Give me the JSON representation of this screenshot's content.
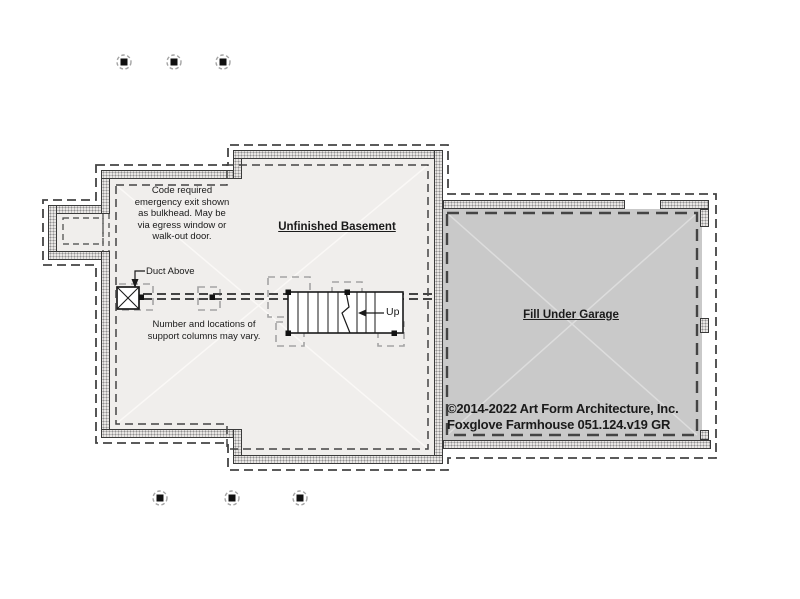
{
  "plan": {
    "labels": {
      "room": "Unfinished Basement",
      "garage": "Fill Under Garage",
      "duct": "Duct Above",
      "stair_direction": "Up"
    },
    "notes": {
      "egress": "Code required\nemergency exit shown\nas bulkhead. May be\nvia egress window or\nwalk-out door.",
      "columns": "Number and locations of\nsupport columns may vary."
    },
    "copyright": {
      "line1": "©2014-2022 Art Form Architecture, Inc.",
      "line2": "Foxglove Farmhouse 051.124.v19 GR"
    },
    "colors": {
      "background": "#ffffff",
      "basement_fill": "#f0eeec",
      "garage_fill": "#c9c9c9",
      "wall_fill": "#e8e6e4",
      "wall_dot": "#8f8f8f",
      "line_dark": "#1a1a1a",
      "dashed_dark": "#444444",
      "footing_dash": "#a4a4a4",
      "text": "#1a1a1a"
    }
  }
}
